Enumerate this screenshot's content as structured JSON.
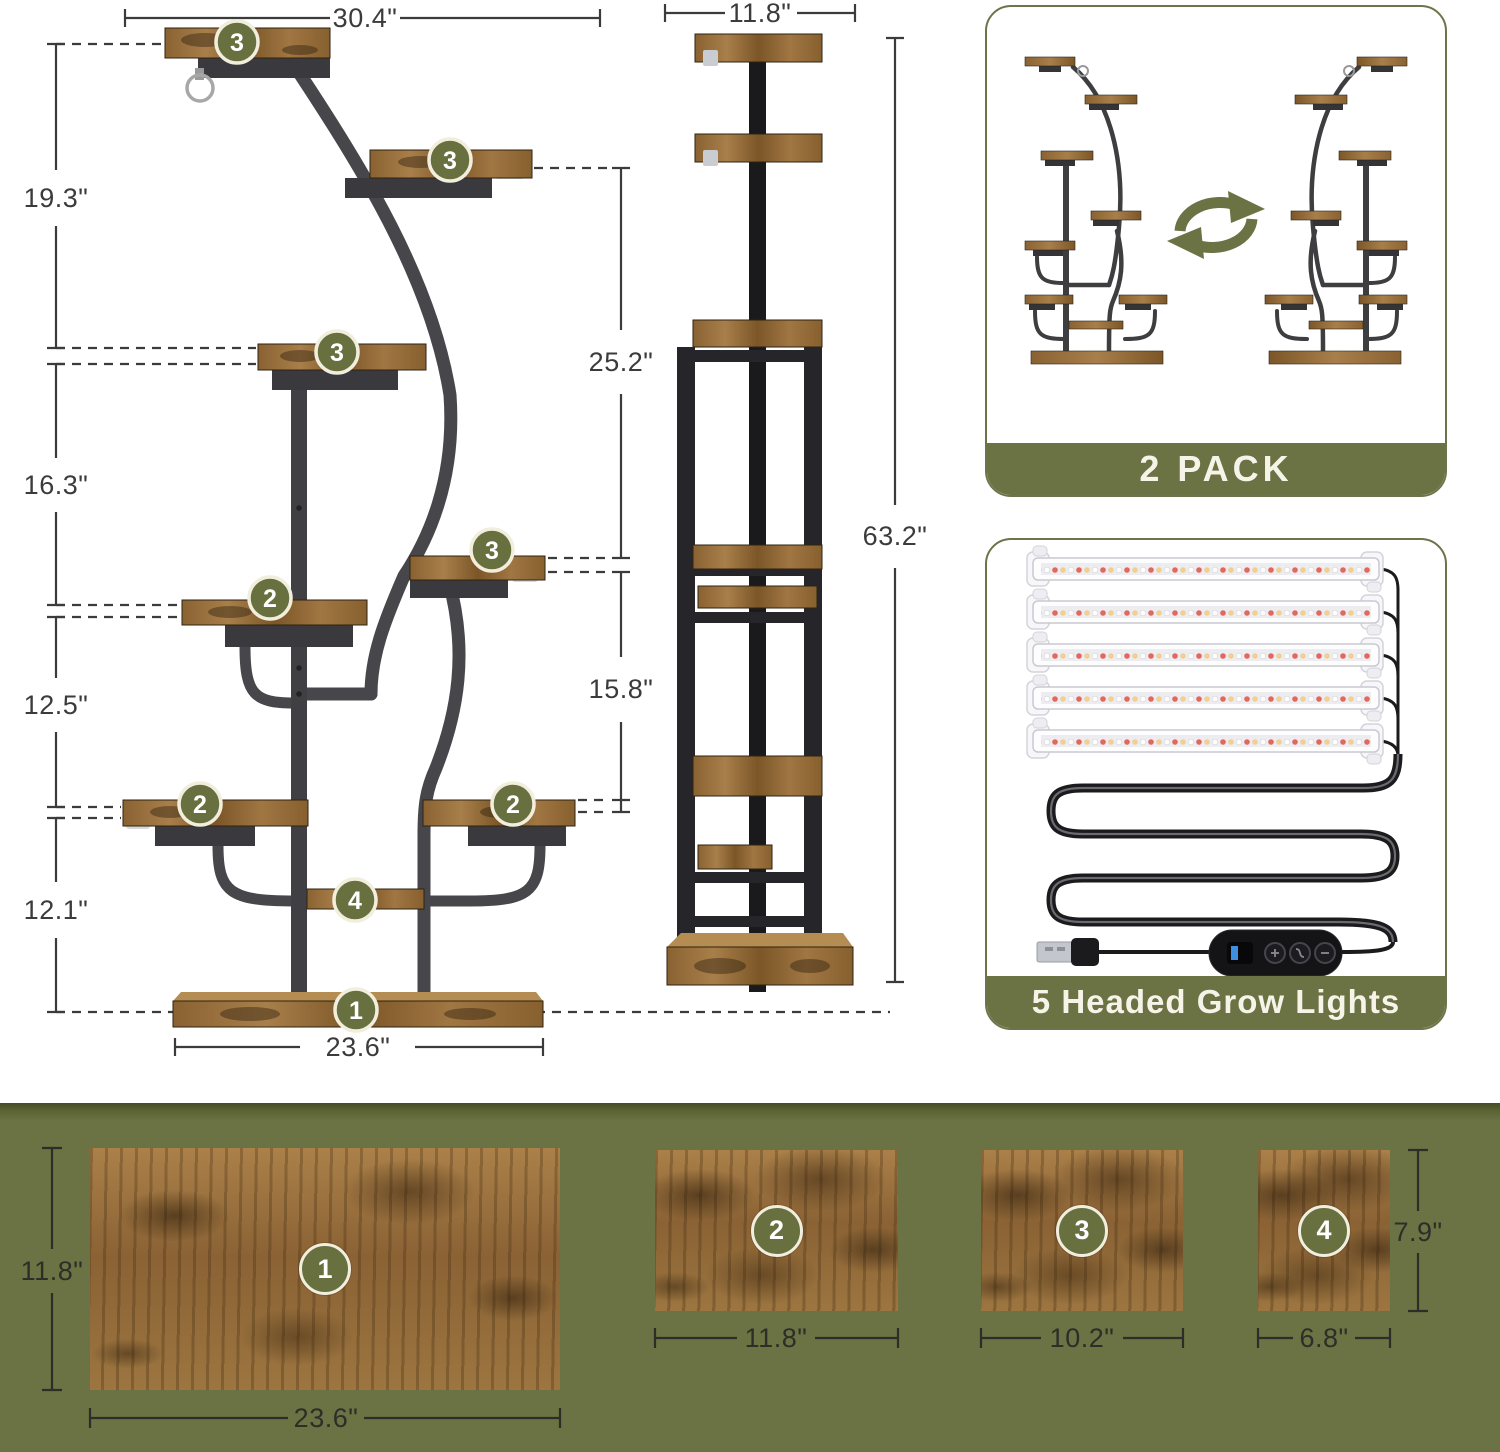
{
  "colors": {
    "accent_olive": "#6b7243",
    "badge_olive": "#687040",
    "badge_ring_cream": "#f2eedd",
    "wood_light": "#a87f4a",
    "wood_dark": "#7a5428",
    "metal_gray": "#47474b",
    "metal_black": "#1d1d20",
    "dim_line": "#3b3b3b"
  },
  "front_view": {
    "dim_top_width": "30.4\"",
    "dim_heights": [
      "19.3\"",
      "16.3\"",
      "12.5\"",
      "12.1\""
    ],
    "dim_base_width": "23.6\"",
    "dim_upper_gap": "25.2\"",
    "dim_lower_gap": "15.8\"",
    "badges": [
      "3",
      "3",
      "3",
      "3",
      "2",
      "2",
      "2",
      "4",
      "1"
    ]
  },
  "side_view": {
    "dim_top_width": "11.8\"",
    "dim_total_height": "63.2\""
  },
  "cards": {
    "two_pack": {
      "banner": "2 PACK"
    },
    "grow_lights": {
      "banner": "5 Headed Grow Lights"
    }
  },
  "shelf_panels": [
    {
      "badge": "1",
      "width": "23.6\"",
      "depth": "11.8\""
    },
    {
      "badge": "2",
      "width": "11.8\""
    },
    {
      "badge": "3",
      "width": "10.2\""
    },
    {
      "badge": "4",
      "width": "6.8\"",
      "depth": "7.9\""
    }
  ],
  "icons": {
    "swap": "swap-arrows-icon",
    "hook": "hook-ring-icon",
    "usb": "usb-plug-icon",
    "controller": "light-controller",
    "light_bar": "grow-light-bar"
  }
}
